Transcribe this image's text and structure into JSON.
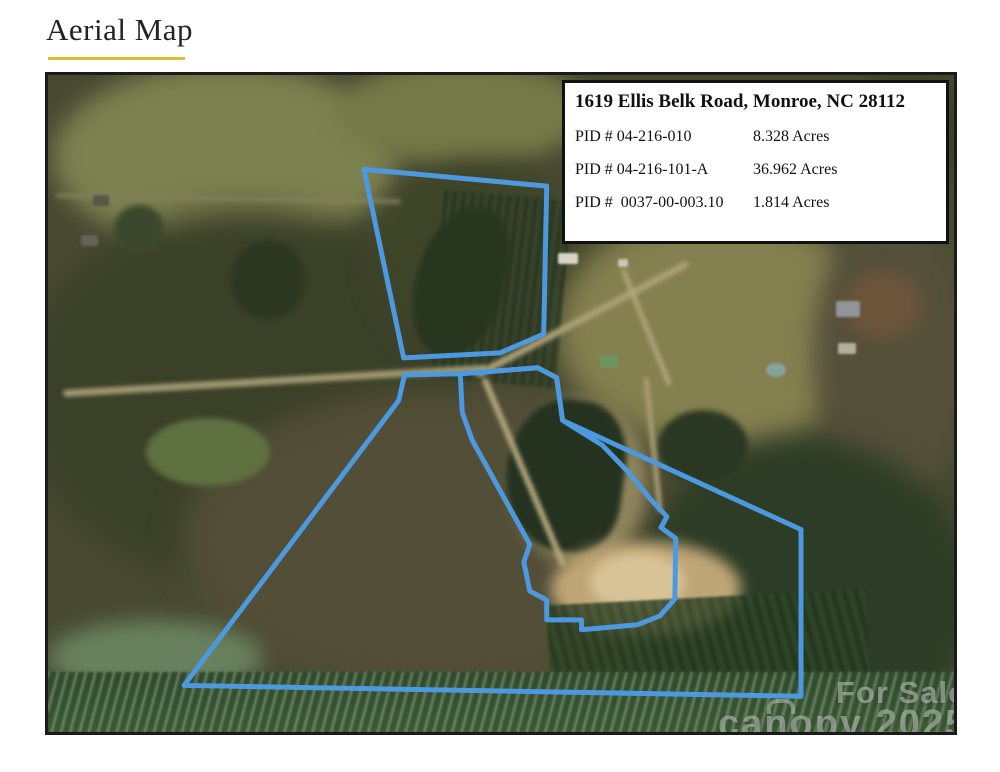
{
  "page": {
    "title": "Aerial Map"
  },
  "info_box": {
    "title": "1619 Ellis Belk Road, Monroe, NC 28112",
    "rows": [
      {
        "pid": "PID # 04-216-010",
        "acres": "8.328 Acres"
      },
      {
        "pid": "PID # 04-216-101-A",
        "acres": "36.962 Acres"
      },
      {
        "pid": "PID #  0037-00-003.10",
        "acres": "1.814 Acres"
      }
    ]
  },
  "watermark": {
    "for_sale": "For Sale",
    "brand": "canopy 2025"
  },
  "map": {
    "boundary_color": "#4c99df",
    "boundary_width": 5,
    "parcels": [
      {
        "name": "parcel-outline-north",
        "points": [
          [
            318,
            95
          ],
          [
            502,
            112
          ],
          [
            499,
            261
          ],
          [
            455,
            280
          ],
          [
            358,
            285
          ]
        ]
      },
      {
        "name": "parcel-outline-main",
        "points": [
          [
            359,
            302
          ],
          [
            415,
            301
          ],
          [
            493,
            295
          ],
          [
            512,
            305
          ],
          [
            518,
            348
          ],
          [
            758,
            458
          ],
          [
            758,
            626
          ],
          [
            137,
            615
          ],
          [
            353,
            328
          ]
        ]
      },
      {
        "name": "parcel-outline-middle",
        "points": [
          [
            415,
            301
          ],
          [
            493,
            295
          ],
          [
            512,
            305
          ],
          [
            518,
            348
          ],
          [
            558,
            373
          ],
          [
            585,
            401
          ],
          [
            607,
            428
          ],
          [
            623,
            445
          ],
          [
            617,
            456
          ],
          [
            632,
            467
          ],
          [
            631,
            528
          ],
          [
            616,
            545
          ],
          [
            593,
            554
          ],
          [
            537,
            559
          ],
          [
            537,
            549
          ],
          [
            502,
            549
          ],
          [
            502,
            529
          ],
          [
            485,
            520
          ],
          [
            479,
            491
          ],
          [
            485,
            473
          ],
          [
            427,
            368
          ],
          [
            417,
            340
          ]
        ]
      }
    ]
  }
}
